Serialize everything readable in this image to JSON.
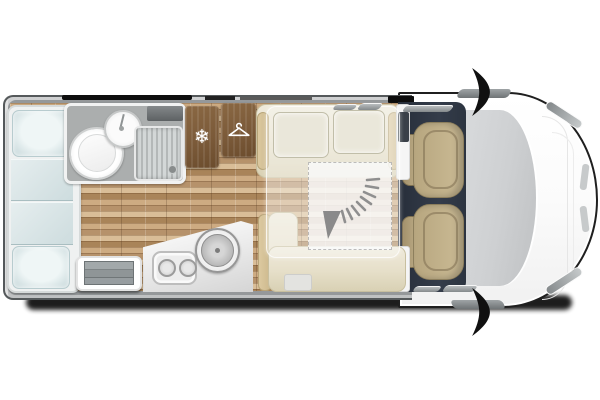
{
  "title": "motorhome-floorplan-top-view",
  "colors": {
    "outline_dark": "#1f1f1f",
    "shadow_black": "#0a0a0a",
    "wall_gray": "#95989a",
    "floor_wood": "#c2a07b",
    "cabinet_brown": "#7b5a39",
    "bed_blue": "#dfe9ea",
    "bench_cream": "#e9e4d1",
    "seat_tan": "#cbbb95",
    "cab_floor_navy": "#343c4a",
    "bathroom_gray": "#abaeae",
    "counter_white": "#f2f2f2",
    "windshield_gray": "#ced0d2",
    "body_white": "#ffffff"
  },
  "icons": {
    "snowflake_glyph": "❄",
    "hanger_icon": "clothes-hanger",
    "drop_down_bed_arrow": "curved-down-arrow",
    "door_swing_arrow": "curved-door-arrow",
    "burner_icon": "hob-burner",
    "sink_icon": "round-sink"
  },
  "areas": {
    "rear": "rear-lounge-beds",
    "washroom": "bathroom-with-shower-toilet-sink",
    "fridge": "freezer-compartment",
    "wardrobe": "hanging-wardrobe",
    "kitchen": "kitchen-hob-and-sink",
    "lounge": "dinette-with-drop-down-bed",
    "cab": "driver-and-passenger-swivel-seats",
    "front": "vehicle-cab-front"
  }
}
